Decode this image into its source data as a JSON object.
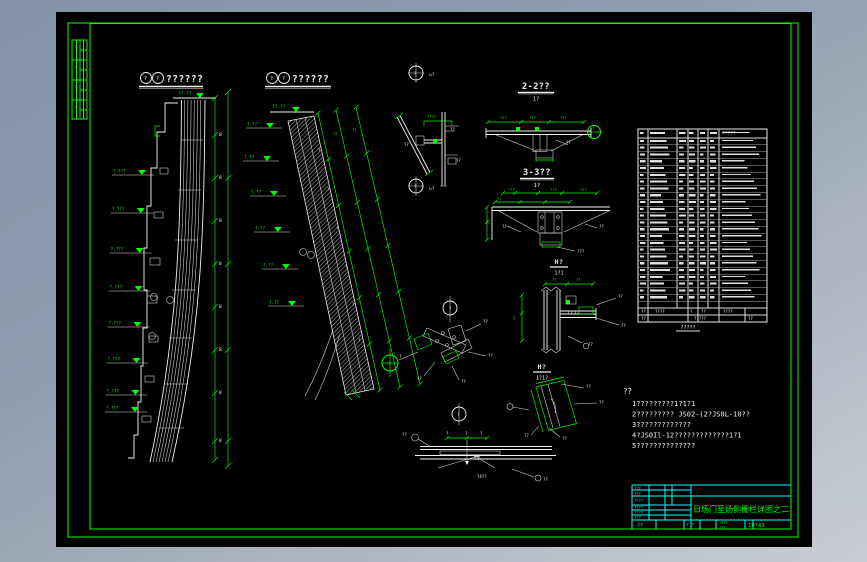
{
  "colors": {
    "line_green": "#00ff00",
    "line_white": "#f2f2f2",
    "title_cyan": "#00ffff",
    "canvas_bg": "#000000",
    "desktop_top": "#8494a8",
    "desktop_bottom": "#c9ced4"
  },
  "headings": [
    {
      "label": "??????"
    },
    {
      "label": "??????"
    }
  ],
  "sections": {
    "s22": {
      "t": "2-2??",
      "s": "1?"
    },
    "s33": {
      "t": "3-3??",
      "s": "1?"
    },
    "h5": {
      "t": "H?",
      "s": "1?1"
    },
    "h6": {
      "t": "H?",
      "s": "1?1?"
    }
  },
  "notes": {
    "title": "??",
    "lines": [
      "1?????????1?1?1",
      "2????????? JS02-(2?JS0L-10??",
      "3?????????????",
      "4?JS0Il-12?????????????1?1",
      "5??????????????"
    ]
  },
  "table": {
    "header_note": "?????",
    "caption": "?????",
    "row_count": 24,
    "summary_row1": [
      "??",
      "????",
      "?",
      "??",
      "????"
    ],
    "summary_row2": [
      "??",
      "?????",
      "??"
    ]
  },
  "title_block": {
    "title": "日场门至炀侧栅栏详图之二",
    "date": "19?43",
    "left": [
      "???",
      "???",
      "????",
      "????",
      "????",
      "???"
    ],
    "bottom": [
      "??",
      "? ?",
      "????",
      "???"
    ]
  },
  "levels": {
    "a_label": "?.???",
    "a": [
      {
        "y": 175
      },
      {
        "y": 213
      },
      {
        "y": 253
      },
      {
        "y": 291
      },
      {
        "y": 327
      },
      {
        "y": 363
      },
      {
        "y": 395
      },
      {
        "y": 412
      }
    ],
    "b_label": "?.??",
    "b": [
      {
        "x": 246,
        "y": 128
      },
      {
        "x": 243,
        "y": 161
      },
      {
        "x": 250,
        "y": 196
      },
      {
        "x": 254,
        "y": 232
      },
      {
        "x": 262,
        "y": 269
      },
      {
        "x": 268,
        "y": 306
      }
    ]
  },
  "tick_chains": {
    "vertical": [
      {
        "x": 215,
        "y1": 98,
        "y2": 460,
        "ys": [
          98,
          135,
          178,
          221,
          264,
          307,
          350,
          393,
          441,
          460
        ]
      },
      {
        "x": 228,
        "y1": 92,
        "y2": 466,
        "ys": [
          92,
          178,
          264,
          350,
          441,
          466
        ]
      }
    ],
    "slant": [
      {
        "x1": 318,
        "y1": 113,
        "x2": 380,
        "y2": 390,
        "n": 6
      },
      {
        "x1": 336,
        "y1": 110,
        "x2": 400,
        "y2": 387,
        "n": 6
      },
      {
        "x1": 356,
        "y1": 107,
        "x2": 420,
        "y2": 384,
        "n": 6
      }
    ]
  },
  "annotations": [
    {
      "x": 178,
      "y": 95,
      "t": "??.??",
      "c": "g",
      "s": 4.5
    },
    {
      "x": 219,
      "y": 136,
      "t": "8",
      "c": "w",
      "s": 4.5
    },
    {
      "x": 219,
      "y": 179,
      "t": "8",
      "c": "w",
      "s": 4.5
    },
    {
      "x": 219,
      "y": 222,
      "t": "8",
      "c": "w",
      "s": 4.5
    },
    {
      "x": 219,
      "y": 265,
      "t": "8",
      "c": "w",
      "s": 4.5
    },
    {
      "x": 219,
      "y": 308,
      "t": "8",
      "c": "w",
      "s": 4.5
    },
    {
      "x": 219,
      "y": 351,
      "t": "8",
      "c": "w",
      "s": 4.5
    },
    {
      "x": 219,
      "y": 394,
      "t": "8",
      "c": "w",
      "s": 4.5
    },
    {
      "x": 219,
      "y": 442,
      "t": "8",
      "c": "w",
      "s": 4.5
    },
    {
      "x": 272,
      "y": 108,
      "t": "??.??",
      "c": "g",
      "s": 4.5
    },
    {
      "x": 318,
      "y": 152,
      "t": "?",
      "c": "w",
      "s": 4
    },
    {
      "x": 327,
      "y": 191,
      "t": "?",
      "c": "w",
      "s": 4
    },
    {
      "x": 336,
      "y": 230,
      "t": "?",
      "c": "w",
      "s": 4
    },
    {
      "x": 345,
      "y": 268,
      "t": "?",
      "c": "w",
      "s": 4
    },
    {
      "x": 352,
      "y": 306,
      "t": "?",
      "c": "w",
      "s": 4
    },
    {
      "x": 358,
      "y": 342,
      "t": "?",
      "c": "w",
      "s": 4
    },
    {
      "x": 333,
      "y": 135,
      "t": "??",
      "c": "g",
      "s": 3.8
    },
    {
      "x": 352,
      "y": 131,
      "t": "??",
      "c": "g",
      "s": 3.8
    },
    {
      "x": 429,
      "y": 76,
      "t": "u?",
      "c": "w",
      "s": 4.5
    },
    {
      "x": 429,
      "y": 190,
      "t": "u?",
      "c": "w",
      "s": 4.5
    },
    {
      "x": 414,
      "y": 75,
      "t": "?",
      "c": "w",
      "s": 4
    },
    {
      "x": 414,
      "y": 188,
      "t": "?",
      "c": "w",
      "s": 4
    },
    {
      "x": 427,
      "y": 118,
      "t": "????",
      "c": "g",
      "s": 3.8
    },
    {
      "x": 404,
      "y": 146,
      "t": "??",
      "c": "w",
      "s": 4
    },
    {
      "x": 450,
      "y": 131,
      "t": "??",
      "c": "w",
      "s": 4
    },
    {
      "x": 456,
      "y": 162,
      "t": "??",
      "c": "w",
      "s": 4
    },
    {
      "x": 500,
      "y": 119,
      "t": "???",
      "c": "g",
      "s": 3.8
    },
    {
      "x": 529,
      "y": 119,
      "t": "???",
      "c": "g",
      "s": 3.8
    },
    {
      "x": 560,
      "y": 119,
      "t": "???",
      "c": "g",
      "s": 3.8
    },
    {
      "x": 566,
      "y": 144,
      "t": "??",
      "c": "w",
      "s": 4
    },
    {
      "x": 592,
      "y": 130,
      "t": "?",
      "c": "g",
      "s": 4
    },
    {
      "x": 508,
      "y": 191,
      "t": "???",
      "c": "g",
      "s": 3.8
    },
    {
      "x": 550,
      "y": 191,
      "t": "???",
      "c": "g",
      "s": 3.8
    },
    {
      "x": 580,
      "y": 191,
      "t": "???",
      "c": "g",
      "s": 3.8
    },
    {
      "x": 497,
      "y": 200,
      "t": "??",
      "c": "g",
      "s": 3.8
    },
    {
      "x": 489,
      "y": 224,
      "t": "??",
      "c": "g",
      "s": 3.8,
      "r": -90
    },
    {
      "x": 502,
      "y": 228,
      "t": "??",
      "c": "w",
      "s": 4
    },
    {
      "x": 599,
      "y": 228,
      "t": "??",
      "c": "w",
      "s": 4
    },
    {
      "x": 577,
      "y": 253,
      "t": "???",
      "c": "w",
      "s": 4
    },
    {
      "x": 552,
      "y": 281,
      "t": "??",
      "c": "g",
      "s": 3.8
    },
    {
      "x": 576,
      "y": 281,
      "t": "??",
      "c": "g",
      "s": 3.8
    },
    {
      "x": 516,
      "y": 320,
      "t": "??",
      "c": "g",
      "s": 3.8,
      "r": -90
    },
    {
      "x": 618,
      "y": 298,
      "t": "??",
      "c": "w",
      "s": 4
    },
    {
      "x": 621,
      "y": 327,
      "t": "??",
      "c": "w",
      "s": 4
    },
    {
      "x": 588,
      "y": 346,
      "t": "??",
      "c": "w",
      "s": 4
    },
    {
      "x": 586,
      "y": 388,
      "t": "??",
      "c": "w",
      "s": 4
    },
    {
      "x": 599,
      "y": 404,
      "t": "??",
      "c": "w",
      "s": 4
    },
    {
      "x": 562,
      "y": 440,
      "t": "??",
      "c": "w",
      "s": 4
    },
    {
      "x": 524,
      "y": 437,
      "t": "??",
      "c": "w",
      "s": 4
    },
    {
      "x": 449,
      "y": 310,
      "t": "?",
      "c": "w",
      "s": 4
    },
    {
      "x": 483,
      "y": 323,
      "t": "??",
      "c": "w",
      "s": 4
    },
    {
      "x": 488,
      "y": 357,
      "t": "??",
      "c": "w",
      "s": 4
    },
    {
      "x": 417,
      "y": 380,
      "t": "??",
      "c": "w",
      "s": 4
    },
    {
      "x": 461,
      "y": 383,
      "t": "??",
      "c": "w",
      "s": 4
    },
    {
      "x": 399,
      "y": 358,
      "t": "?",
      "c": "w",
      "s": 4.5
    },
    {
      "x": 386,
      "y": 365,
      "t": "??",
      "c": "g",
      "s": 3.5
    },
    {
      "x": 457,
      "y": 416,
      "t": "?",
      "c": "w",
      "s": 4
    },
    {
      "x": 446,
      "y": 435,
      "t": "?",
      "c": "w",
      "s": 4
    },
    {
      "x": 465,
      "y": 435,
      "t": "?",
      "c": "w",
      "s": 4
    },
    {
      "x": 480,
      "y": 435,
      "t": "?",
      "c": "w",
      "s": 4
    },
    {
      "x": 402,
      "y": 436,
      "t": "??",
      "c": "w",
      "s": 4
    },
    {
      "x": 477,
      "y": 478,
      "t": "?4??",
      "c": "w",
      "s": 4
    },
    {
      "x": 543,
      "y": 481,
      "t": "??",
      "c": "w",
      "s": 4
    },
    {
      "x": 74,
      "y": 49,
      "t": "?",
      "c": "g",
      "s": 4
    },
    {
      "x": 74,
      "y": 69,
      "t": "?",
      "c": "g",
      "s": 4
    },
    {
      "x": 74,
      "y": 89,
      "t": "?",
      "c": "g",
      "s": 4
    },
    {
      "x": 74,
      "y": 109,
      "t": "?",
      "c": "g",
      "s": 4
    },
    {
      "x": 144,
      "y": 80,
      "t": "?",
      "c": "w",
      "s": 5
    },
    {
      "x": 156,
      "y": 80,
      "t": "?",
      "c": "w",
      "s": 5
    },
    {
      "x": 270,
      "y": 80,
      "t": "?",
      "c": "w",
      "s": 5
    },
    {
      "x": 282,
      "y": 80,
      "t": "?",
      "c": "w",
      "s": 5
    }
  ]
}
